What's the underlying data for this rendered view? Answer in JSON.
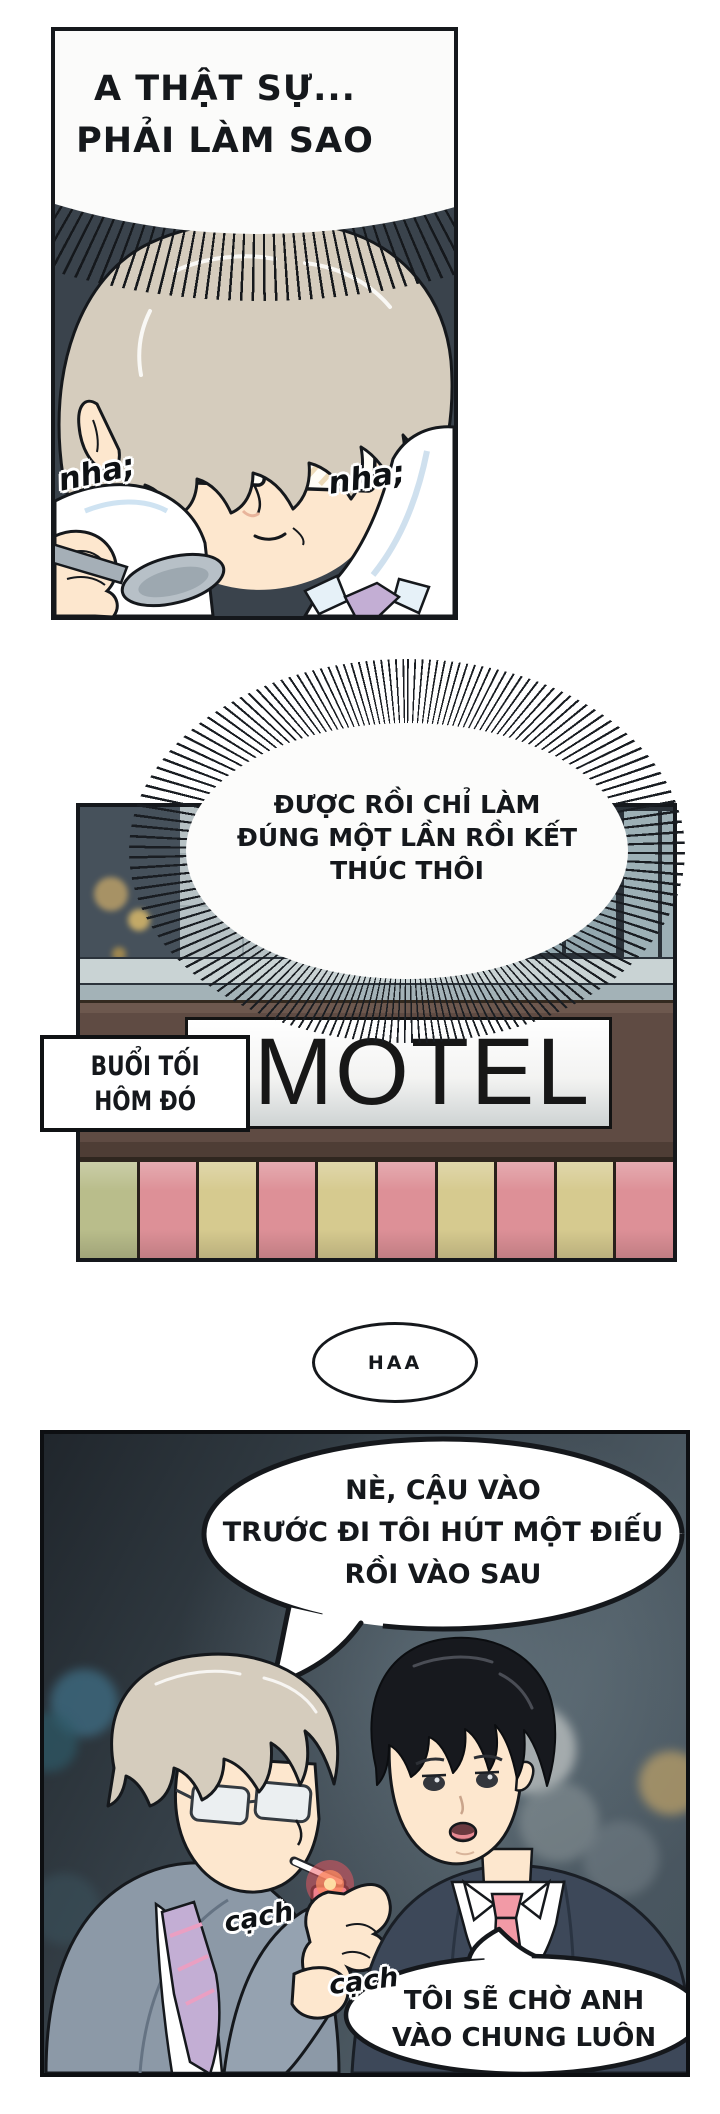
{
  "comic": {
    "panel1": {
      "bubble_text": "A THẬT SỰ...\nPHẢI LÀM SAO",
      "sfx_left": "nha;",
      "sfx_right": "nha;"
    },
    "panel2": {
      "burst_text": "ĐƯỢC RỒI CHỈ LÀM\nĐÚNG MỘT LẦN RỒI KẾT\nTHÚC THÔI",
      "caption": "BUỔI TỐI\nHÔM ĐÓ",
      "sign": "MOTEL"
    },
    "interlude_sfx": "HAA",
    "panel3": {
      "bubble_text": "NÈ, CẬU VÀO\nTRƯỚC ĐI TÔI HÚT MỘT ĐIẾU\nRỒI VÀO SAU",
      "sfx_click_1": "cạch",
      "sfx_click_2": "cạch",
      "reply_text": "TÔI SẼ CHỜ ANH\nVÀO CHUNG LUÔN"
    }
  },
  "colors": {
    "ink": "#15181c",
    "paper": "#ffffff",
    "panel1-bg": "#3a434c",
    "skin": "#fde7ce",
    "hair-beige": "#d5ccbd",
    "hair-black": "#17191e",
    "tie-lavender": "#c3aed4",
    "tie-pink": "#f29aa6",
    "suit-gray": "#8c99a7",
    "suit-navy": "#3d4859",
    "spoon-gray": "#a5afb7",
    "wall-light": "#b6c1c4",
    "wall-dark": "#46515b",
    "window-pane": "#93a7ae",
    "facade-brown": "#5f4b43",
    "sign-face": "#ffffff",
    "awning-pink": "#dd9097",
    "awning-yellow": "#d6ca8f",
    "awning-green": "#b9bd8b",
    "night-1": "#20262c",
    "night-2": "#4c5962",
    "lighter-pink": "#f2a9b8",
    "flame-red": "#ef5660",
    "bokeh-blue": "#3f6e85",
    "bokeh-yellow": "#c0a368"
  }
}
